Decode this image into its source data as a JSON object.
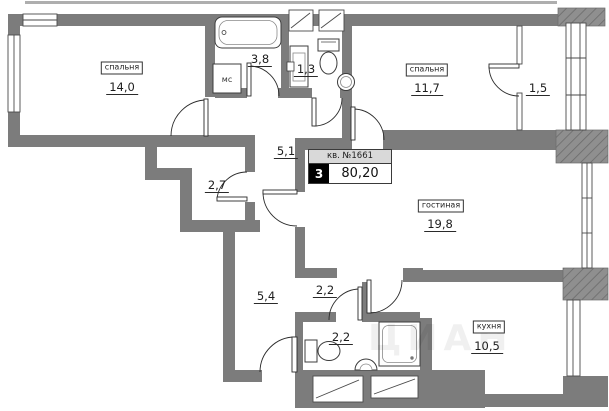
{
  "plan": {
    "apartment": {
      "label": "кв. №1661",
      "rooms_count": "3",
      "total_area": "80,20"
    },
    "rooms": [
      {
        "id": "bedroom-1",
        "name": "спальня",
        "area": "14,0"
      },
      {
        "id": "bathroom-1",
        "name": "",
        "area": "3,8"
      },
      {
        "id": "wc-1",
        "name": "",
        "area": "1,3"
      },
      {
        "id": "bedroom-2",
        "name": "спальня",
        "area": "11,7"
      },
      {
        "id": "balcony",
        "name": "",
        "area": "1,5"
      },
      {
        "id": "hallway",
        "name": "",
        "area": "5,1"
      },
      {
        "id": "closet",
        "name": "",
        "area": "2,7"
      },
      {
        "id": "living",
        "name": "гостиная",
        "area": "19,8"
      },
      {
        "id": "corridor",
        "name": "",
        "area": "5,4"
      },
      {
        "id": "hall-2",
        "name": "",
        "area": "2,2"
      },
      {
        "id": "bathroom-2",
        "name": "",
        "area": "2,2"
      },
      {
        "id": "kitchen",
        "name": "кухня",
        "area": "10,5"
      }
    ],
    "appliance_label": "мс",
    "watermark": "ЦИАН",
    "colors": {
      "wall": "#7c7c7c",
      "hatch_base": "#8f8f8f",
      "hatch_line": "#6b6b6b",
      "line": "#2b2b2b"
    }
  }
}
